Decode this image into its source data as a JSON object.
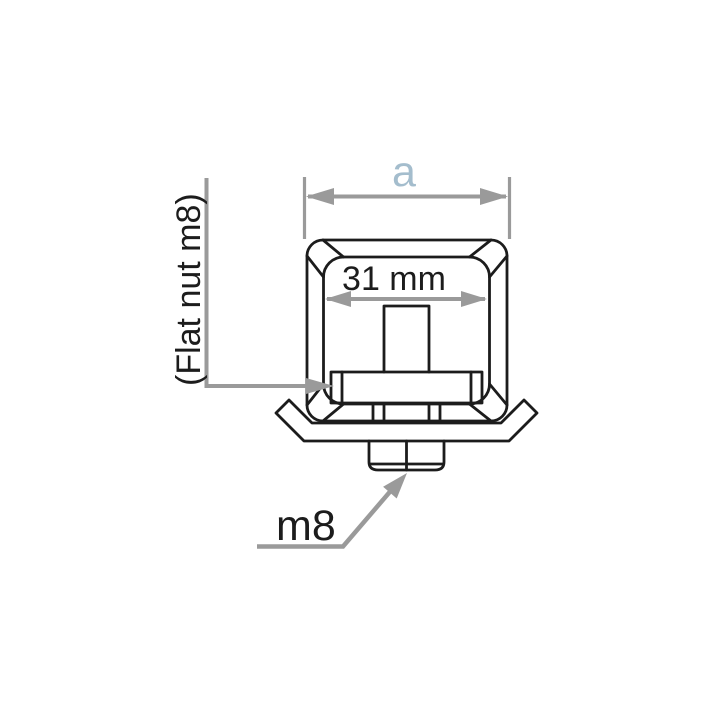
{
  "title": "Square tube / flat nut cross-section drawing",
  "colors": {
    "line_black": "#1c1c1c",
    "dimension_gray": "#9a9a9a",
    "label_a_blue": "#a4bdcd",
    "background": "#ffffff"
  },
  "annotations": {
    "width_label": "a",
    "inner_width_label": "31 mm",
    "nut_label": "(Flat nut m8)",
    "bolt_label": "m8"
  }
}
